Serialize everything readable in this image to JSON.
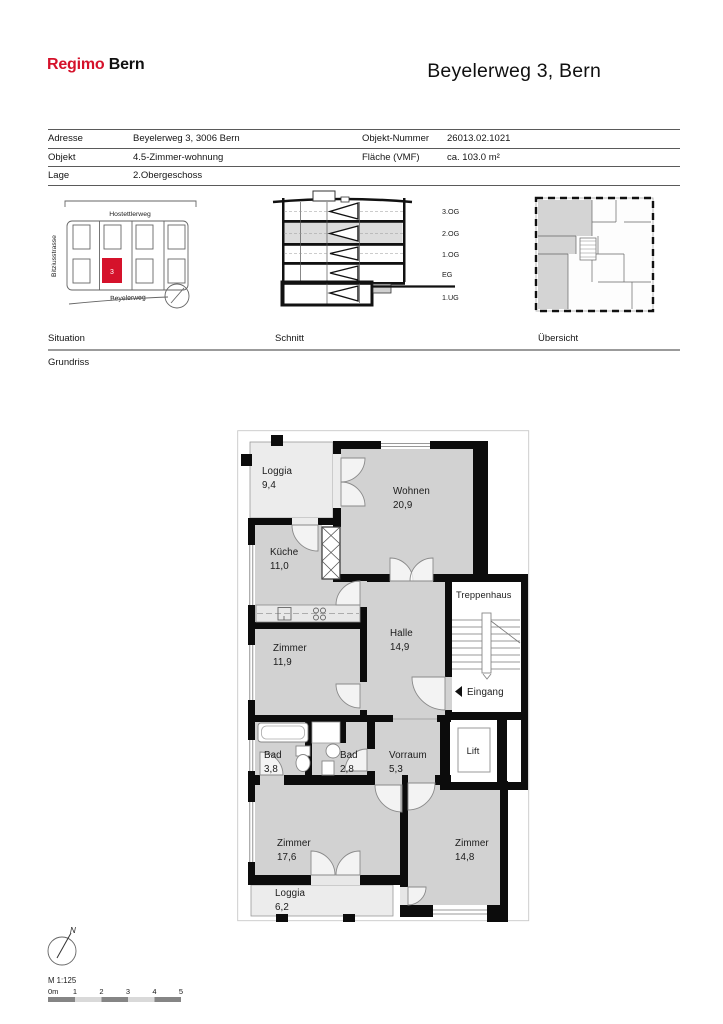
{
  "colors": {
    "accent_red": "#d5122b",
    "room_fill": "#d2d2d2",
    "loggia_fill": "#ececec",
    "wall": "#0c0c0c"
  },
  "header": {
    "logo_primary": "Regimo",
    "logo_secondary": "Bern",
    "title": "Beyelerweg 3, Bern"
  },
  "info": {
    "rows": [
      {
        "label": "Adresse",
        "value": "Beyelerweg 3, 3006 Bern",
        "label2": "Objekt-Nummer",
        "value2": "26013.02.1021"
      },
      {
        "label": "Objekt",
        "value": "4.5-Zimmer-wohnung",
        "label2": "Fläche (VMF)",
        "value2": "ca. 103.0 m²"
      },
      {
        "label": "Lage",
        "value": "2.Obergeschoss",
        "label2": "",
        "value2": ""
      }
    ]
  },
  "diagrams": {
    "situation": {
      "label": "Situation",
      "street_top": "Hostettlerweg",
      "street_left": "Bitziusstrasse",
      "street_bottom": "Beyelerweg",
      "marker": "3"
    },
    "schnitt": {
      "label": "Schnitt",
      "floors": [
        "3.OG",
        "2.OG",
        "1.OG",
        "EG",
        "1.UG"
      ]
    },
    "uebersicht": {
      "label": "Übersicht"
    }
  },
  "plan": {
    "label": "Grundriss",
    "rooms": [
      {
        "name": "Loggia",
        "area": "9,4"
      },
      {
        "name": "Wohnen",
        "area": "20,9"
      },
      {
        "name": "Küche",
        "area": "11,0"
      },
      {
        "name": "Zimmer",
        "area": "11,9"
      },
      {
        "name": "Halle",
        "area": "14,9"
      },
      {
        "name": "Treppenhaus",
        "area": ""
      },
      {
        "name": "Eingang",
        "area": ""
      },
      {
        "name": "Bad",
        "area": "3,8"
      },
      {
        "name": "Bad",
        "area": "2,8"
      },
      {
        "name": "Vorraum",
        "area": "5,3"
      },
      {
        "name": "Lift",
        "area": ""
      },
      {
        "name": "Zimmer",
        "area": "17,6"
      },
      {
        "name": "Zimmer",
        "area": "14,8"
      },
      {
        "name": "Loggia",
        "area": "6,2"
      }
    ]
  },
  "footer": {
    "north_label": "N",
    "scale_label": "M 1:125",
    "scale_ticks": [
      "0m",
      "1",
      "2",
      "3",
      "4",
      "5"
    ]
  }
}
